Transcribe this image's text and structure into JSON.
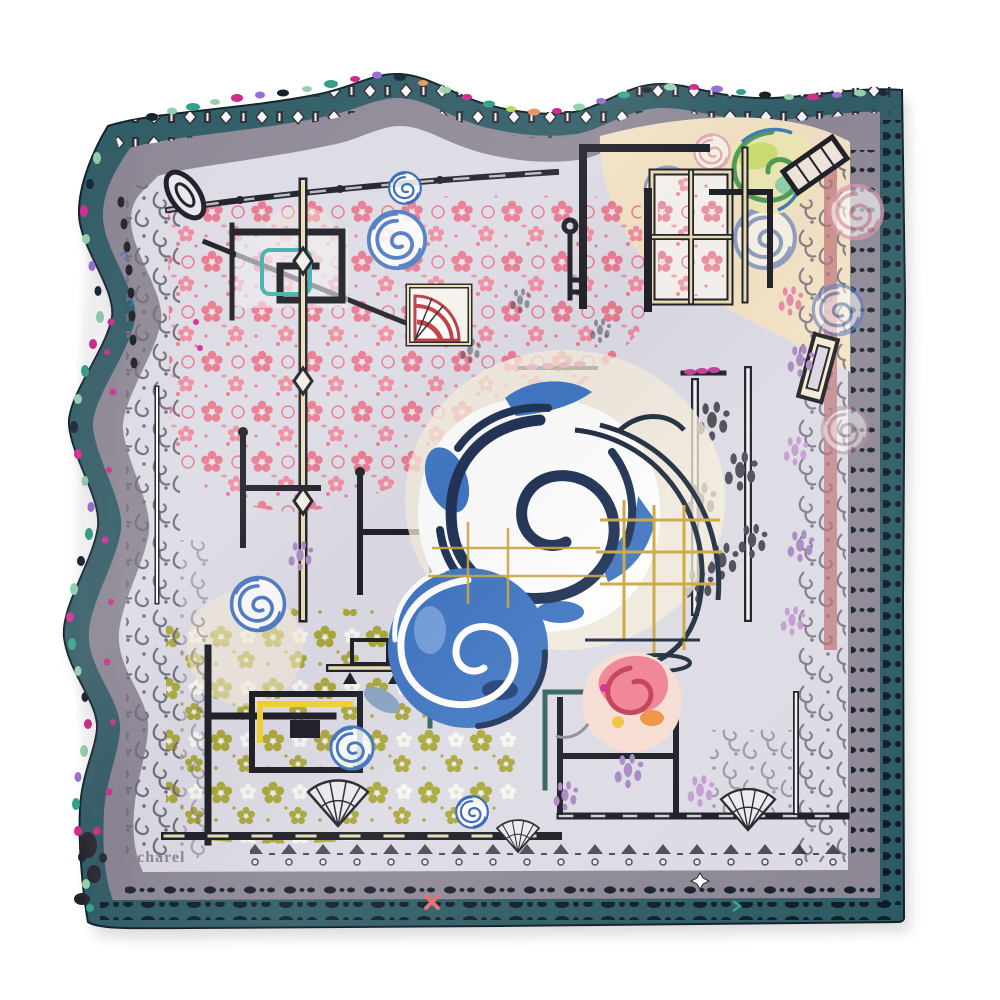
{
  "product": {
    "brand_signature": "cacharel"
  },
  "palette": {
    "page_bg": "#ffffff",
    "border_teal": "#2c5a63",
    "border_teal_right": "#35566a",
    "band_grey": "#8d8694",
    "field_lavender": "#dcdae3",
    "lace_pink": "#e97288",
    "lace_olive": "#a9a637",
    "cream": "#f3e2c3",
    "rose_blue": "#3c73c0",
    "rose_navy": "#1c2f52",
    "frame_black": "#1a1a22",
    "frame_beige": "#e9ddb2",
    "cage_gold": "#c9a43c",
    "accent_magenta": "#d3288e",
    "accent_mint": "#93d2ae",
    "accent_green": "#35a08a",
    "accent_purple": "#9a6fd8",
    "accent_orange": "#e8955a",
    "accent_lime": "#b8d85a",
    "rose_coral": "#e8566a",
    "rose_orange": "#f09040",
    "rose_yellow": "#f0c23e",
    "damask_grey": "#6f6a78",
    "signature_grey": "#8a8590"
  }
}
